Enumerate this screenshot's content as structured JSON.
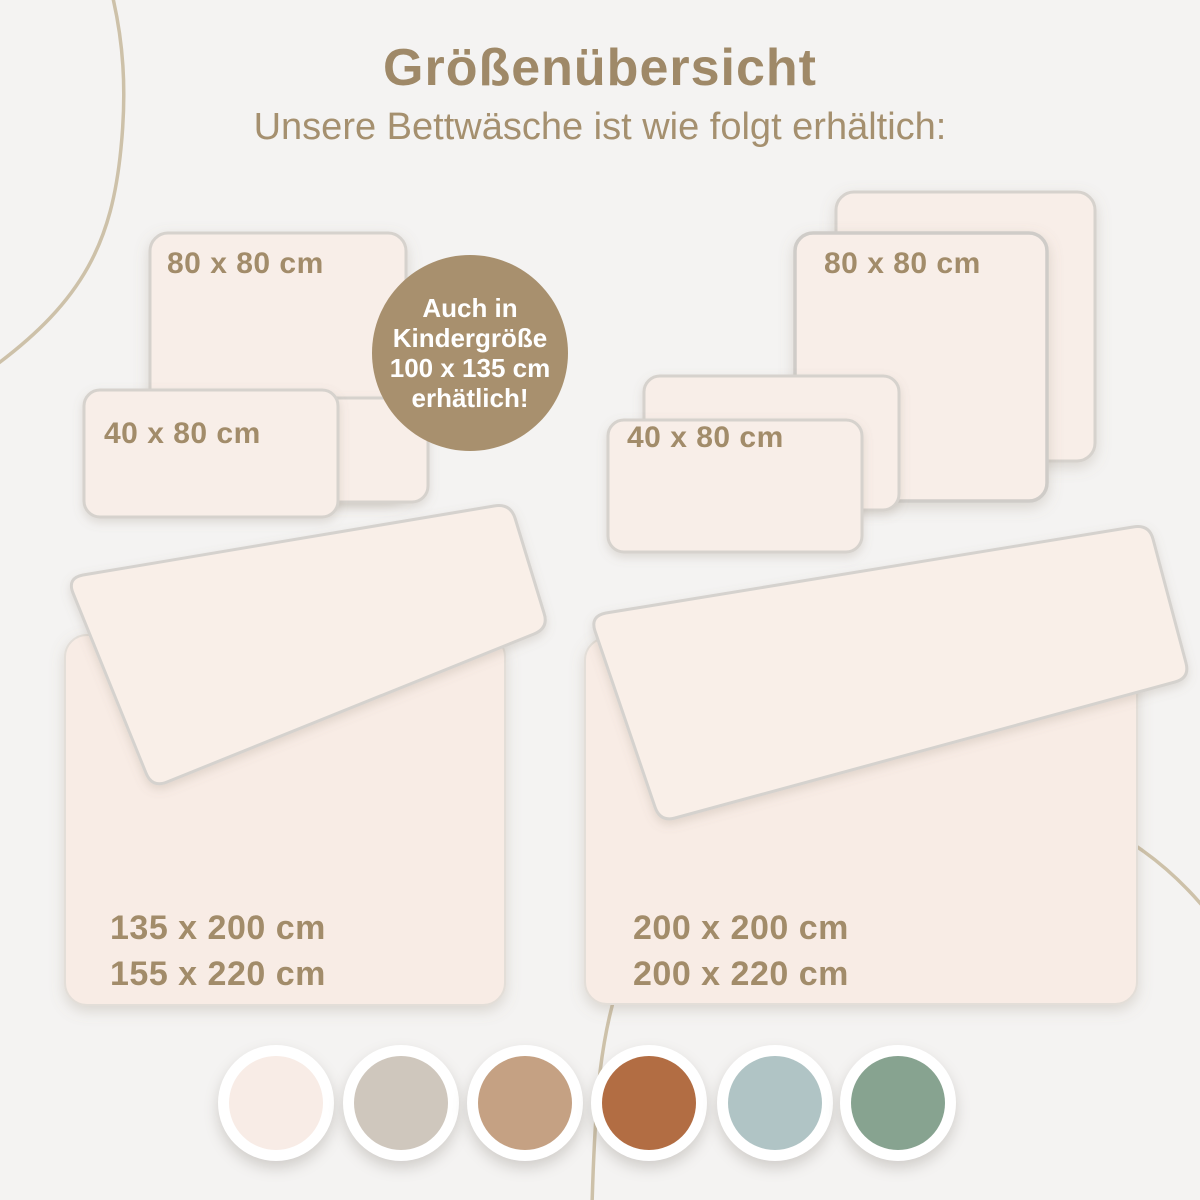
{
  "header": {
    "title": "Größenübersicht",
    "subtitle": "Unsere Bettwäsche ist wie folgt erhältich:"
  },
  "badge": {
    "line1": "Auch in",
    "line2": "Kindergröße",
    "line3": "100 x 135 cm",
    "line4": "erhätlich!",
    "bg_color": "#a8906e"
  },
  "pillows": {
    "left_square_label": "80 x 80 cm",
    "left_rect_label": "40 x 80 cm",
    "right_square_label": "80 x 80 cm",
    "right_rect_label": "40 x 80 cm"
  },
  "duvets": {
    "left": {
      "size1": "135 x 200 cm",
      "size2": "155 x 220 cm"
    },
    "right": {
      "size1": "200 x 200 cm",
      "size2": "200 x 220 cm"
    }
  },
  "swatches": [
    {
      "name": "cream",
      "hex": "#f8ece6"
    },
    {
      "name": "greige",
      "hex": "#cfc7bd"
    },
    {
      "name": "tan",
      "hex": "#c5a183"
    },
    {
      "name": "terracotta",
      "hex": "#b26d43"
    },
    {
      "name": "light-blue",
      "hex": "#b0c4c5"
    },
    {
      "name": "sage",
      "hex": "#87a390"
    }
  ],
  "accent_text_color": "#a28c6a",
  "background_color": "#f4f3f2"
}
